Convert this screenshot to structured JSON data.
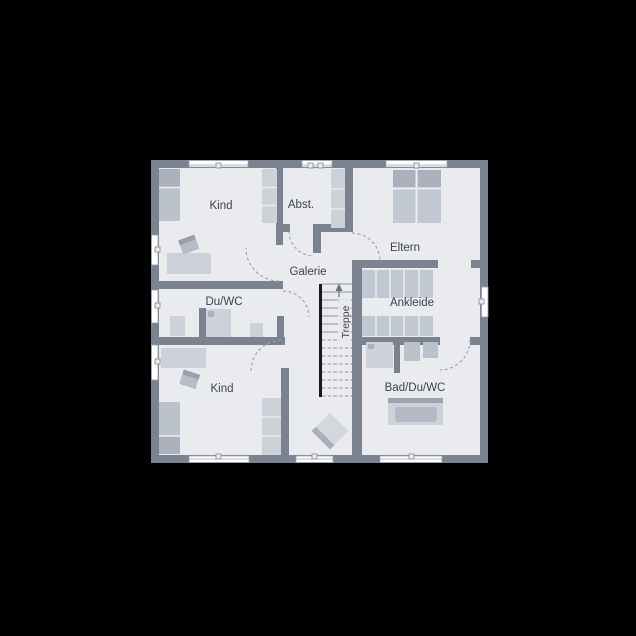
{
  "plan": {
    "kind": "floor-plan",
    "rooms": {
      "kind_top": {
        "label": "Kind"
      },
      "abst": {
        "label": "Abst."
      },
      "eltern": {
        "label": "Eltern"
      },
      "galerie": {
        "label": "Galerie"
      },
      "du_wc": {
        "label": "Du/WC"
      },
      "ankleide": {
        "label": "Ankleide"
      },
      "treppe": {
        "label": "Treppe"
      },
      "bad_du_wc": {
        "label": "Bad/Du/WC"
      },
      "kind_bottom": {
        "label": "Kind"
      }
    },
    "colors": {
      "background": "#000000",
      "wall": "#7b8290",
      "floor": "#e9ebef",
      "furniture_light": "#cdd2da",
      "furniture_medium": "#bcc2cc",
      "furniture_dark": "#aab1bc",
      "window": "#ffffff",
      "stair_stringer": "#16181c",
      "label_text": "#3d434d"
    }
  }
}
